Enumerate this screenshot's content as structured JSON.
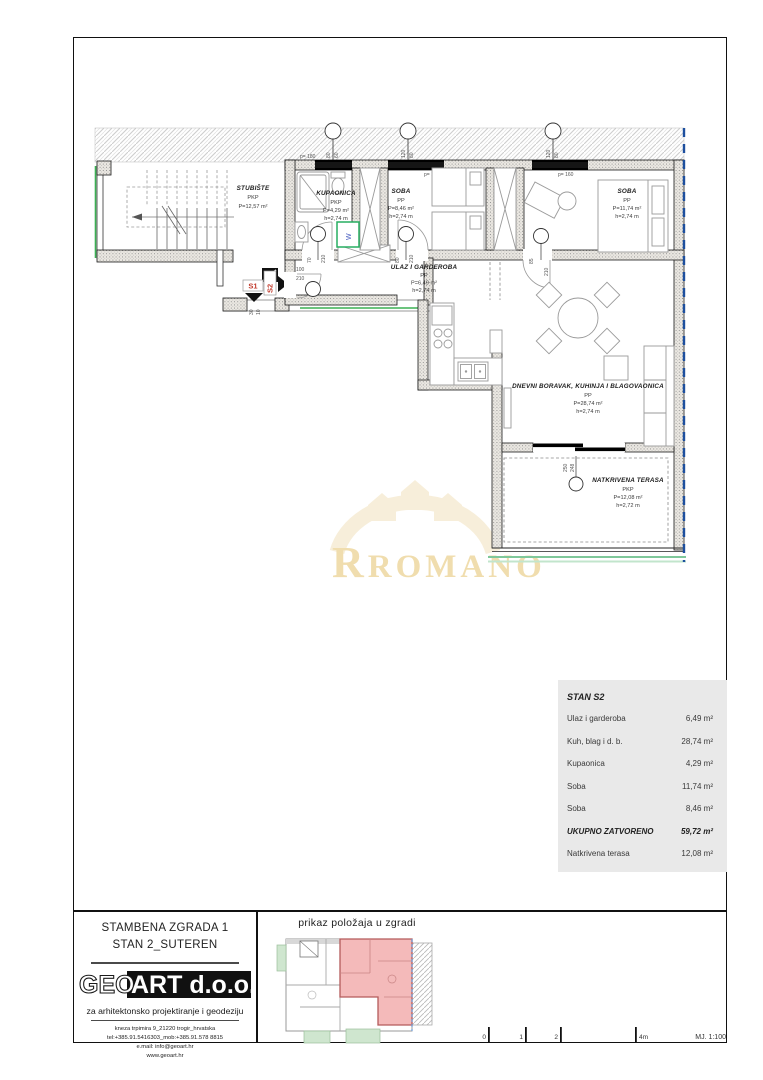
{
  "plan": {
    "rooms": [
      {
        "name": "STUBIŠTE",
        "cat": "PKP",
        "area": "P=12,57 m²",
        "h": ""
      },
      {
        "name": "KUPAONICA",
        "cat": "PKP",
        "area": "P=4,29 m²",
        "h": "h=2,74 m"
      },
      {
        "name": "SOBA",
        "cat": "PP",
        "area": "P=8,46 m²",
        "h": "h=2,74 m"
      },
      {
        "name": "SOBA",
        "cat": "PP",
        "area": "P=11,74 m²",
        "h": "h=2,74 m"
      },
      {
        "name": "ULAZ I GARDEROBA",
        "cat": "PP",
        "area": "P=6,49 m²",
        "h": "h=2,74 m"
      },
      {
        "name": "DNEVNI BORAVAK, KUHINJA I BLAGOVAONICA",
        "cat": "PP",
        "area": "P=28,74 m²",
        "h": "h=2,74 m"
      },
      {
        "name": "NATKRIVENA TERASA",
        "cat": "PKP",
        "area": "P=12,08 m²",
        "h": "h=2,72 m"
      }
    ],
    "windows": [
      {
        "a": "80",
        "b": "60",
        "p": "p= 180"
      },
      {
        "a": "120",
        "b": "80",
        "p": "p= 160"
      },
      {
        "a": "120",
        "b": "80",
        "p": "p= 160"
      }
    ],
    "doors": [
      {
        "a": "70",
        "b": "210"
      },
      {
        "a": "80",
        "b": "210"
      },
      {
        "a": "85",
        "b": "210"
      },
      {
        "a": "100",
        "b": "210"
      },
      {
        "a": "250",
        "b": "248"
      }
    ],
    "misc": {
      "washer": "W",
      "s1": "S1",
      "s2": "S2",
      "dim_a": "30",
      "dim_b": "10"
    }
  },
  "watermark": {
    "text": "ROMANO"
  },
  "area_table": {
    "title": "STAN S2",
    "rows": [
      {
        "label": "Ulaz i garderoba",
        "value": "6,49 m²"
      },
      {
        "label": "Kuh, blag i d. b.",
        "value": "28,74 m²"
      },
      {
        "label": "Kupaonica",
        "value": "4,29 m²"
      },
      {
        "label": "Soba",
        "value": "11,74 m²"
      },
      {
        "label": "Soba",
        "value": "8,46 m²"
      },
      {
        "label": "UKUPNO ZATVORENO",
        "value": "59,72 m²"
      },
      {
        "label": "Natkrivena terasa",
        "value": "12,08 m²"
      }
    ]
  },
  "title_block": {
    "line1": "STAMBENA ZGRADA 1",
    "line2": "STAN 2_SUTEREN",
    "logo_geo": "GEO",
    "logo_art": "ART d.o.o.",
    "tagline": "za arhitektonsko projektiranje i geodeziju",
    "address": "kneza trpimira 9_21220 trogir_hrvatska",
    "contact": "tel:+385.91.5416303_mob:+385.91.578 8815",
    "email": "e.mail: info@geoart.hr",
    "web": "www.geoart.hr"
  },
  "minimap": {
    "title": "prikaz položaja u zgradi"
  },
  "scalebar": {
    "ticks": [
      "0",
      "1",
      "2",
      "4m"
    ],
    "scale_label": "MJ. 1:100"
  }
}
